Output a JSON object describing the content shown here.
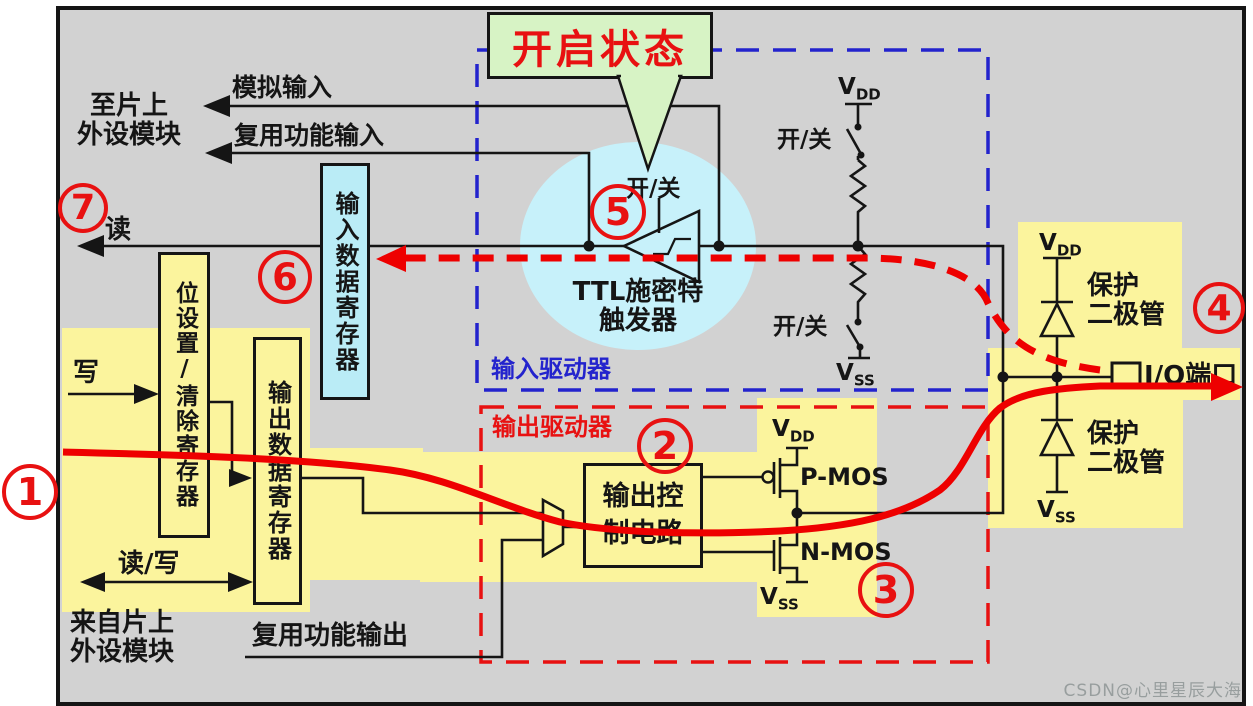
{
  "labels": {
    "to_onchip_1": "至片上",
    "to_onchip_2": "外设模块",
    "analog_input": "模拟输入",
    "af_input": "复用功能输入",
    "read": "读",
    "write": "写",
    "read_write": "读/写",
    "from_onchip_1": "来自片上",
    "from_onchip_2": "外设模块",
    "af_output": "复用功能输出",
    "callout": "开启状态",
    "on_off": "开/关",
    "schmitt_1": "TTL施密特",
    "schmitt_2": "触发器",
    "input_data_register": "输入数据寄存器",
    "bit_set_clear_register": "位设置/清除寄存器",
    "output_data_register": "输出数据寄存器",
    "input_driver": "输入驱动器",
    "output_driver": "输出驱动器",
    "output_control_1": "输出控",
    "output_control_2": "制电路",
    "pmos": "P-MOS",
    "nmos": "N-MOS",
    "protect_1": "保护",
    "protect_2": "二极管",
    "io_port": "I/O端口",
    "v": "V",
    "dd": "DD",
    "ss": "SS"
  },
  "markers": {
    "m1": "1",
    "m2": "2",
    "m3": "3",
    "m4": "4",
    "m5": "5",
    "m6": "6",
    "m7": "7"
  },
  "watermark": "CSDN@心里星辰大海",
  "colors": {
    "panel_bg": "#d2d2d2",
    "highlight_yellow": "#fbf49d",
    "register_cyan": "#baecf6",
    "schmitt_halo_cyan": "#c7f1fa",
    "callout_green": "#d7f3c5",
    "accent_red": "#e81111",
    "accent_blue": "#2323cd"
  }
}
